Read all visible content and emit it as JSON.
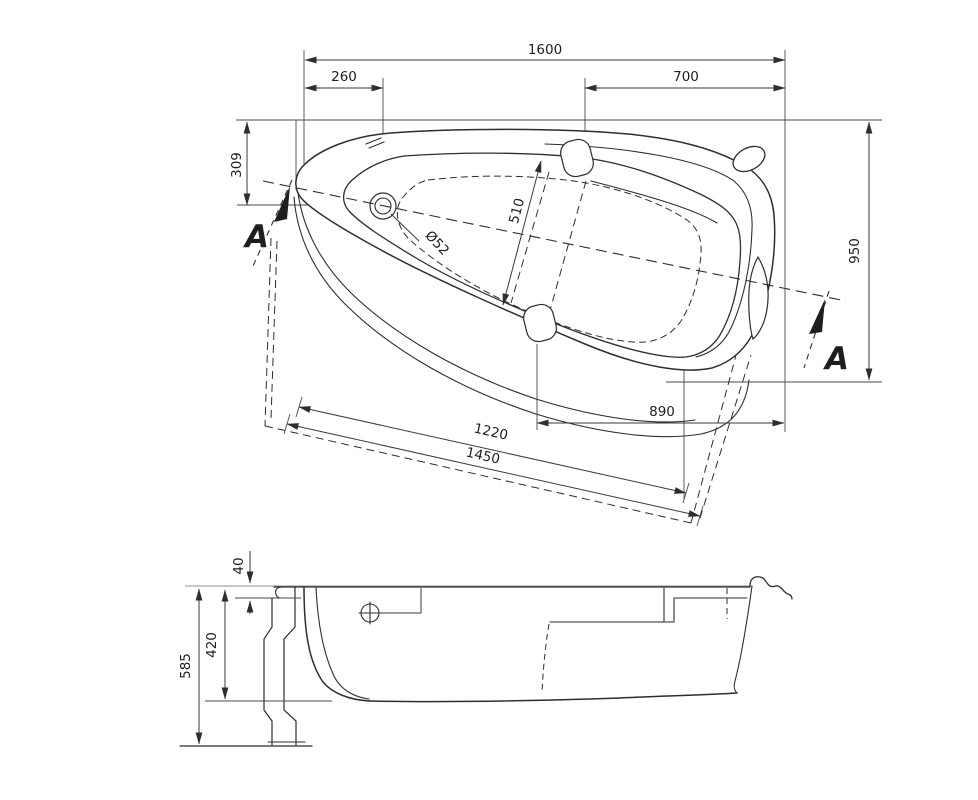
{
  "top_view": {
    "dims": {
      "total_length": "1600",
      "drain_offset_left": "260",
      "offset_right": "700",
      "drain_offset_top": "309",
      "total_width": "950",
      "seat_width": "510",
      "drain_diameter": "Ø52",
      "bottom_right_span": "890",
      "front_edge_upper": "1220",
      "front_edge_lower": "1450"
    },
    "section_label_left": "A",
    "section_label_right": "A"
  },
  "side_view": {
    "dims": {
      "rim_height": "40",
      "shell_depth": "420",
      "total_height": "585"
    }
  }
}
